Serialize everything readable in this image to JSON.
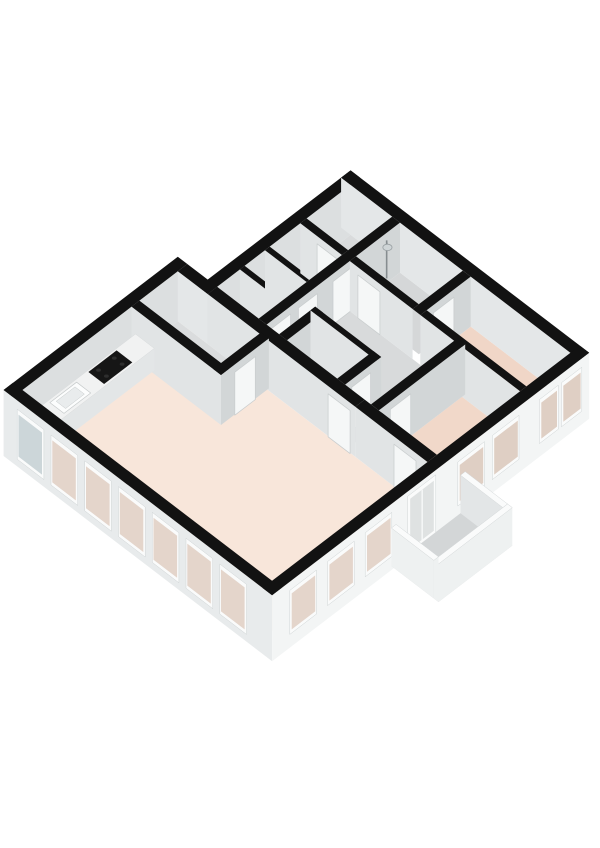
{
  "canvas": {
    "width": 600,
    "height": 848,
    "background": "#ffffff"
  },
  "projection": {
    "ox": 13,
    "oy": 440,
    "ax": 0.785,
    "ay": 0.6,
    "wall_top": 50,
    "exterior_base": -16
  },
  "palette": {
    "wall_top_black": "#121212",
    "ext_face_sw": "#e8ebec",
    "ext_face_se": "#f3f5f5",
    "inner_nw": "#dcdfe0",
    "inner_ne": "#e4e7e8",
    "face_se": "#d2d6d7",
    "face_sw": "#e1e4e5",
    "door_fill": "#f5f7f7",
    "door_stroke": "#c9cdce",
    "frame": "#fafbfb",
    "frame_stroke": "#cfd4d5",
    "glass_gray": "#ccd6d9",
    "glass_peach": "#e4d5cb",
    "glass_peach_dark": "#dfcfc4",
    "counter_top": "#f1f2f2",
    "counter_front": "#e3e6e7",
    "counter_end": "#d9dcdd",
    "counter_stroke": "#d8dbdc",
    "sink_fill": "#fcfdfd",
    "sink_basin": "#e9eced",
    "sink_stroke": "#c6cacb",
    "cooktop": "#161616",
    "burner": "#2e2e2e",
    "toilet_fill": "#fbfcfc",
    "toilet_side": "#eceeee",
    "toilet_stroke": "#c2c6c7",
    "shower_pole": "#868d90",
    "shower_head": "#cfd5d7",
    "shower_stroke": "#989fa2",
    "balcony_floor": "#d3d6d7",
    "rail_top": "#fafbfb",
    "rail_outer": "#eef1f1",
    "rail_inner": "#e3e6e7",
    "rail_stroke": "#d3d7d8",
    "door_glass": "#dfe2e2"
  },
  "scene": [
    {
      "t": "floor",
      "n": "floor-living-room",
      "rect": [
        6,
        204,
        6,
        324
      ],
      "c": "#f8e6da"
    },
    {
      "t": "floor",
      "n": "floor-storage-room",
      "rect": [
        155,
        204,
        6,
        110
      ],
      "c": "#dadcdd"
    },
    {
      "t": "floor",
      "n": "floor-closet-1",
      "rect": [
        216,
        245,
        44,
        97
      ],
      "c": "#d6d8d9"
    },
    {
      "t": "floor",
      "n": "floor-closet-2",
      "rect": [
        251,
        277,
        44,
        97
      ],
      "c": "#d7d9da"
    },
    {
      "t": "floor",
      "n": "floor-storage-2",
      "rect": [
        283,
        322,
        44,
        97
      ],
      "c": "#d7d9da"
    },
    {
      "t": "floor",
      "n": "floor-top-room",
      "rect": [
        330,
        386,
        44,
        97
      ],
      "c": "#d9dbdc"
    },
    {
      "t": "floor",
      "n": "floor-hallway",
      "poly": [
        [
          216,
          107
        ],
        [
          322,
          107
        ],
        [
          322,
          240
        ],
        [
          216,
          240
        ],
        [
          216,
          207
        ],
        [
          262,
          207
        ],
        [
          262,
          123
        ],
        [
          216,
          123
        ]
      ],
      "c": "#d8dadb"
    },
    {
      "t": "floor",
      "n": "floor-bathroom",
      "rect": [
        330,
        386,
        107,
        187
      ],
      "c": "#d5d7d8"
    },
    {
      "t": "floor",
      "n": "floor-wc",
      "rect": [
        216,
        256,
        133,
        197
      ],
      "c": "#d6d8d9"
    },
    {
      "t": "floor",
      "n": "floor-bedroom-1",
      "rect": [
        216,
        322,
        250,
        324
      ],
      "c": "#f1d8c9"
    },
    {
      "t": "floor",
      "n": "floor-bedroom-2",
      "rect": [
        330,
        386,
        197,
        324
      ],
      "c": "#f0d6c7"
    },
    {
      "t": "wall",
      "n": "wall-ext-nw-left",
      "rect": [
        -6,
        216,
        -6,
        6
      ],
      "faces": {
        "se": "#dcdfe0"
      }
    },
    {
      "t": "wall",
      "n": "wall-ext-nw-upper",
      "rect": [
        204,
        398,
        32,
        44
      ],
      "faces": {
        "se": "#dcdfe0"
      }
    },
    {
      "t": "wall",
      "n": "wall-ext-notch",
      "rect": [
        204,
        216,
        6,
        44
      ],
      "faces": {
        "sw": "#e4e7e8",
        "se": "#d2d6d7"
      }
    },
    {
      "t": "wall",
      "n": "wall-ext-ne",
      "rect": [
        386,
        398,
        32,
        336
      ],
      "faces": {
        "sw": "#e4e7e8"
      }
    },
    {
      "t": "wall",
      "n": "wall-closet-divider-1",
      "rect": [
        245,
        251,
        44,
        97
      ],
      "faces": {
        "sw": "#e1e4e5"
      }
    },
    {
      "t": "wall",
      "n": "wall-closet-divider-2",
      "rect": [
        277,
        283,
        44,
        97
      ],
      "faces": {
        "sw": "#e1e4e5"
      }
    },
    {
      "t": "wall",
      "n": "wall-storage-toproom",
      "rect": [
        322,
        330,
        44,
        97
      ],
      "faces": {
        "sw": "#e1e4e5"
      },
      "doors": [
        {
          "side": "sw",
          "from": 66,
          "to": 92
        }
      ]
    },
    {
      "t": "wall",
      "n": "wall-north-row",
      "rect": [
        216,
        386,
        97,
        107
      ],
      "faces": {
        "se": "#d2d6d7"
      },
      "doors": [
        {
          "side": "se",
          "from": 222,
          "to": 246
        },
        {
          "side": "se",
          "from": 256,
          "to": 280
        },
        {
          "side": "se",
          "from": 300,
          "to": 324
        }
      ]
    },
    {
      "t": "shower",
      "n": "shower-fixture",
      "at": [
        366,
        110
      ]
    },
    {
      "t": "wall",
      "n": "wall-wc-nw",
      "rect": [
        216,
        262,
        123,
        133
      ],
      "faces": {
        "se": "#d2d6d7"
      }
    },
    {
      "t": "toilet",
      "n": "toilet-fixture",
      "at": [
        224,
        160
      ]
    },
    {
      "t": "wall",
      "n": "wall-wc-ne",
      "rect": [
        256,
        262,
        123,
        207
      ],
      "faces": {
        "sw": "#e1e4e5"
      }
    },
    {
      "t": "wall",
      "n": "wall-wc-se",
      "rect": [
        216,
        262,
        197,
        207
      ],
      "faces": {
        "se": "#d2d6d7"
      },
      "doors": [
        {
          "side": "se",
          "from": 224,
          "to": 248
        }
      ]
    },
    {
      "t": "wall",
      "n": "wall-party-north",
      "rect": [
        204,
        216,
        44,
        232
      ],
      "faces": {
        "sw": "#e1e4e5"
      },
      "doors": [
        {
          "side": "sw",
          "from": 198,
          "to": 226
        }
      ]
    },
    {
      "t": "wall",
      "n": "wall-storage-sw",
      "rect": [
        145,
        155,
        6,
        120
      ],
      "faces": {
        "sw": "#e1e4e5"
      }
    },
    {
      "t": "wall",
      "n": "wall-storage-se",
      "rect": [
        145,
        206,
        110,
        120
      ],
      "faces": {
        "se": "#d2d6d7"
      },
      "doors": [
        {
          "side": "se",
          "from": 162,
          "to": 188
        }
      ]
    },
    {
      "t": "wall",
      "n": "wall-bath-sw",
      "rect": [
        322,
        330,
        107,
        187
      ],
      "faces": {
        "sw": "#e1e4e5"
      },
      "doors": [
        {
          "side": "sw",
          "from": 118,
          "to": 146
        }
      ]
    },
    {
      "t": "wall",
      "n": "wall-bath-se",
      "rect": [
        322,
        386,
        187,
        197
      ],
      "faces": {
        "se": "#d2d6d7"
      },
      "doors": [
        {
          "side": "se",
          "from": 338,
          "to": 364
        }
      ]
    },
    {
      "t": "wall",
      "n": "wall-bedroom2-sw",
      "rect": [
        322,
        330,
        197,
        324
      ],
      "faces": {
        "sw": "#e1e4e5"
      }
    },
    {
      "t": "wall",
      "n": "wall-hall-bedroom1",
      "rect": [
        216,
        326,
        240,
        250
      ],
      "faces": {
        "se": "#d2d6d7"
      },
      "doors": [
        {
          "side": "se",
          "from": 230,
          "to": 256
        }
      ]
    },
    {
      "t": "wall",
      "n": "wall-party-south",
      "rect": [
        204,
        216,
        232,
        324
      ],
      "faces": {
        "sw": "#e1e4e5"
      },
      "doors": [
        {
          "side": "sw",
          "from": 282,
          "to": 310
        }
      ]
    },
    {
      "t": "counter",
      "n": "kitchen-counter",
      "rect": [
        14,
        148,
        8,
        32
      ],
      "h": 22,
      "sink": [
        36,
        70,
        11,
        29
      ],
      "basin": [
        41,
        65,
        14,
        26
      ],
      "cooktop": [
        86,
        122,
        10,
        30
      ],
      "burners": [
        [
          94,
          15
        ],
        [
          114,
          15
        ],
        [
          94,
          25
        ],
        [
          114,
          25
        ]
      ]
    },
    {
      "t": "wall",
      "n": "wall-ext-sw",
      "rect": [
        -6,
        6,
        -6,
        336
      ],
      "base": -16,
      "faces": {
        "sw": "#e8ebec",
        "outer": true
      },
      "windows": [
        {
          "side": "sw",
          "from": 14,
          "to": 44,
          "glass": "#ccd6d9"
        },
        {
          "side": "sw",
          "from": 57,
          "to": 87,
          "glass": "#e4d5cb"
        },
        {
          "side": "sw",
          "from": 100,
          "to": 130,
          "glass": "#e4d5cb"
        },
        {
          "side": "sw",
          "from": 143,
          "to": 173,
          "glass": "#e4d5cb"
        },
        {
          "side": "sw",
          "from": 186,
          "to": 216,
          "glass": "#e4d5cb"
        },
        {
          "side": "sw",
          "from": 229,
          "to": 259,
          "glass": "#e4d5cb"
        },
        {
          "side": "sw",
          "from": 272,
          "to": 302,
          "glass": "#e4d5cb"
        }
      ]
    },
    {
      "t": "wall",
      "n": "wall-ext-se",
      "rect": [
        -6,
        398,
        324,
        336
      ],
      "base": -16,
      "faces": {
        "se": "#f3f5f5",
        "outer": true
      },
      "windows": [
        {
          "side": "se",
          "from": 18,
          "to": 48,
          "glass": "#e4d5cb"
        },
        {
          "side": "se",
          "from": 66,
          "to": 96,
          "glass": "#e4d5cb"
        },
        {
          "side": "se",
          "from": 114,
          "to": 144,
          "glass": "#e4d5cb"
        },
        {
          "side": "se",
          "from": 232,
          "to": 262,
          "glass": "#dfcfc4"
        },
        {
          "side": "se",
          "from": 276,
          "to": 306,
          "glass": "#dfcfc4"
        },
        {
          "side": "se",
          "from": 336,
          "to": 356,
          "glass": "#dfcfc4"
        },
        {
          "side": "se",
          "from": 364,
          "to": 386,
          "glass": "#dfcfc4"
        }
      ],
      "glazed_doors": [
        {
          "side": "se",
          "from": 168,
          "to": 200
        }
      ]
    },
    {
      "t": "balcony",
      "n": "balcony",
      "floor": [
        146,
        240,
        336,
        396
      ],
      "floor_z": -12,
      "rail_h": 26,
      "rails": [
        {
          "n": "balcony-rail-east",
          "rect": [
            234,
            240,
            336,
            390
          ],
          "faces": {
            "sw": "#e3e6e7",
            "se": "#eef1f1"
          }
        },
        {
          "n": "balcony-rail-south",
          "rect": [
            146,
            240,
            390,
            396
          ],
          "faces": {
            "se": "#eef1f1",
            "sw": "#eef1f1"
          }
        },
        {
          "n": "balcony-rail-west",
          "rect": [
            146,
            152,
            336,
            390
          ],
          "faces": {
            "sw": "#eef1f1",
            "se": "#eef1f1"
          }
        }
      ]
    }
  ]
}
